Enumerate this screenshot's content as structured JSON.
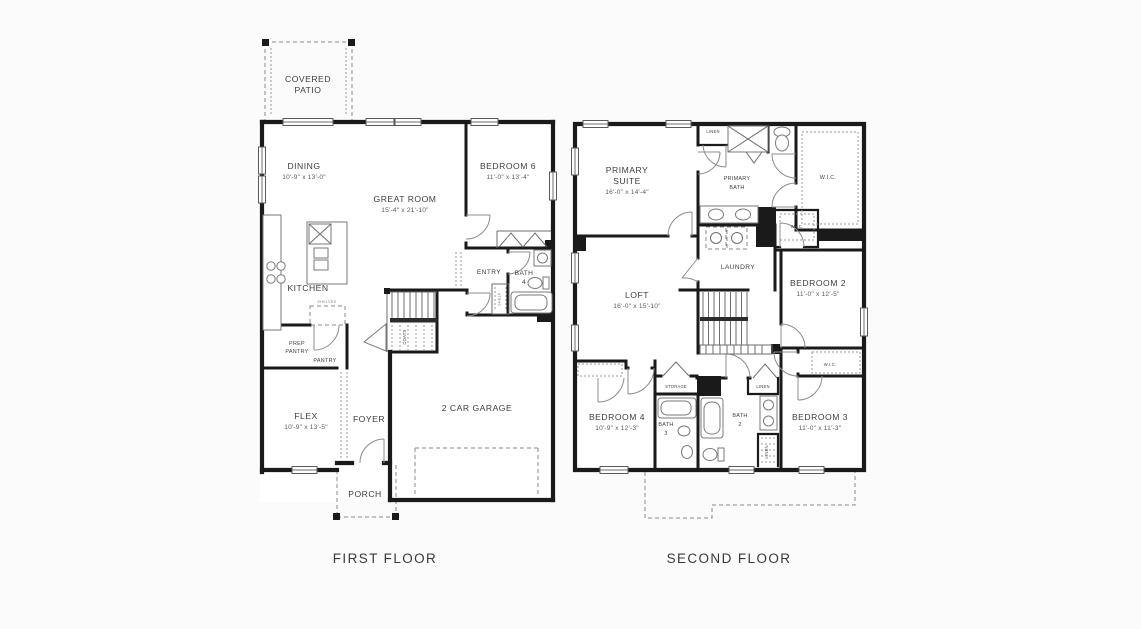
{
  "page": {
    "background": "#fbfbfb",
    "paper": "#ffffff",
    "ink": "#1a1a1a",
    "text_color": "#3e3e3e"
  },
  "first_floor": {
    "caption": "FIRST FLOOR",
    "rooms": {
      "covered_patio": {
        "l1": "COVERED",
        "l2": "PATIO"
      },
      "dining": {
        "name": "DINING",
        "dims": "10'-9\" x 13'-0\""
      },
      "great_room": {
        "name": "GREAT ROOM",
        "dims": "15'-4\" x 21'-10\""
      },
      "bedroom6": {
        "name": "BEDROOM 6",
        "dims": "11'-0\" x 13'-4\""
      },
      "kitchen": {
        "name": "KITCHEN"
      },
      "entry": {
        "name": "ENTRY"
      },
      "bath4": {
        "l1": "BATH",
        "l2": "4"
      },
      "prep_pantry": {
        "l1": "PREP",
        "l2": "PANTRY"
      },
      "pantry": {
        "name": "PANTRY"
      },
      "coats": {
        "name": "COATS"
      },
      "shelf": {
        "name": "SHELF"
      },
      "cabinet": {
        "name": "SHELVES"
      },
      "flex": {
        "name": "FLEX",
        "dims": "10'-9\" x 13'-5\""
      },
      "foyer": {
        "name": "FOYER"
      },
      "garage": {
        "name": "2 CAR GARAGE"
      },
      "porch": {
        "name": "PORCH"
      }
    }
  },
  "second_floor": {
    "caption": "SECOND FLOOR",
    "rooms": {
      "primary_suite": {
        "l1": "PRIMARY",
        "l2": "SUITE",
        "dims": "16'-0\" x 14'-4\""
      },
      "linen_top": {
        "name": "LINEN"
      },
      "primary_bath": {
        "l1": "PRIMARY",
        "l2": "BATH"
      },
      "wic_primary": {
        "name": "W.I.C."
      },
      "wic_bedroom2": {
        "name": "W.I.C."
      },
      "laundry": {
        "name": "LAUNDRY"
      },
      "loft": {
        "name": "LOFT",
        "dims": "16'-0\" x 15'-10\""
      },
      "bedroom2": {
        "name": "BEDROOM 2",
        "dims": "11'-0\" x 12'-5\""
      },
      "wic_bedroom3": {
        "name": "W.I.C."
      },
      "storage": {
        "name": "STORAGE"
      },
      "linen_mid": {
        "name": "LINEN"
      },
      "linen_low": {
        "name": "LINEN"
      },
      "bedroom4": {
        "name": "BEDROOM 4",
        "dims": "10'-9\" x 12'-3\""
      },
      "bath3": {
        "l1": "BATH",
        "l2": "3"
      },
      "bath2": {
        "l1": "BATH",
        "l2": "2"
      },
      "bedroom3": {
        "name": "BEDROOM 3",
        "dims": "11'-0\" x 11'-3\""
      }
    }
  }
}
